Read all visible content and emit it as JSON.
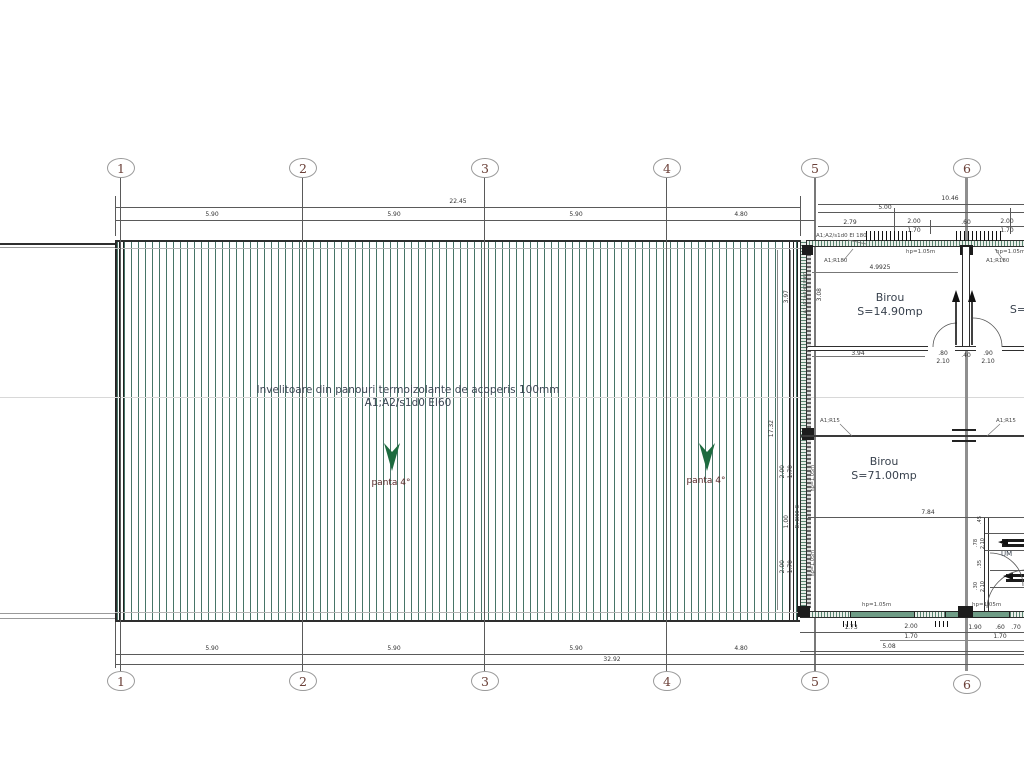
{
  "colors": {
    "hatch_green": "#467567",
    "arrow_green": "#1d6b3f",
    "slope_text": "#5a2b2b",
    "axis_number": "#6b4038"
  },
  "axes": {
    "labels": [
      "1",
      "2",
      "3",
      "4",
      "5",
      "6"
    ]
  },
  "top_dims": {
    "total": "22.45",
    "right_total": "10.46",
    "seg_1_2": "5.90",
    "seg_2_3": "5.90",
    "seg_3_4": "5.90",
    "seg_4_5": "4.80",
    "right_span": "5.00",
    "sub_a": "2.79",
    "sub_b": "2.00",
    "sub_b2": "1.70",
    "sub_c": ".60",
    "sub_d": "2.00",
    "sub_d2": "1.70"
  },
  "bottom_dims": {
    "seg_1_2": "5.90",
    "seg_2_3": "5.90",
    "seg_3_4": "5.90",
    "seg_4_5": "4.80",
    "total": "32.92",
    "annex_a": "1.73",
    "annex_b": "2.00",
    "annex_b2": "1.70",
    "annex_c": "1.90",
    "annex_d": ".60",
    "annex_d2": "1.70",
    "annex_e": ".70",
    "annex_total": "5.08"
  },
  "roof": {
    "note_line1": "Invelitoare din panouri termoizolante de acoperis 100mm",
    "note_line2": "A1;A2/s1d0 EI60",
    "slope_left": "panta 4°",
    "slope_right": "panta 4°"
  },
  "rooms": {
    "office1_name": "Birou",
    "office1_area": "S=14.90mp",
    "office2_name": "Birou",
    "office2_area": "S=71.00mp",
    "office3_area": "S=",
    "utility": "UM"
  },
  "annex": {
    "inner_width": "4.9925",
    "room1_width": "3.94",
    "door1_width": ".80",
    "door1_height": "2.10",
    "pier": ".40",
    "door2_width": ".90",
    "door2_height": "2.10",
    "beam_span": "7.84",
    "height_upper": "3.08",
    "height_total": "17.32",
    "west_a": "3.97",
    "west_b": "2.00",
    "west_b2": "1.70",
    "west_c": "1.00",
    "west_d": "2.00",
    "west_d2": "1.70",
    "um_a": ".45",
    "um_b": ".78",
    "um_b2": "2.10",
    "um_c": ".35",
    "um_d": ".30",
    "um_d2": "2.10"
  },
  "notes": {
    "wall_fire": "A1;A2/s1d0 EI 180",
    "beam_fire_left": "A1;R180",
    "beam_fire_right": "A1;R180",
    "beam15_left": "A1;R15",
    "beam15_right": "A1;R15",
    "hp": "hp=1.05m",
    "wall_fire_vert": "A1;A2/s1d0 EI60",
    "door_spec": "D; EI60-C"
  }
}
